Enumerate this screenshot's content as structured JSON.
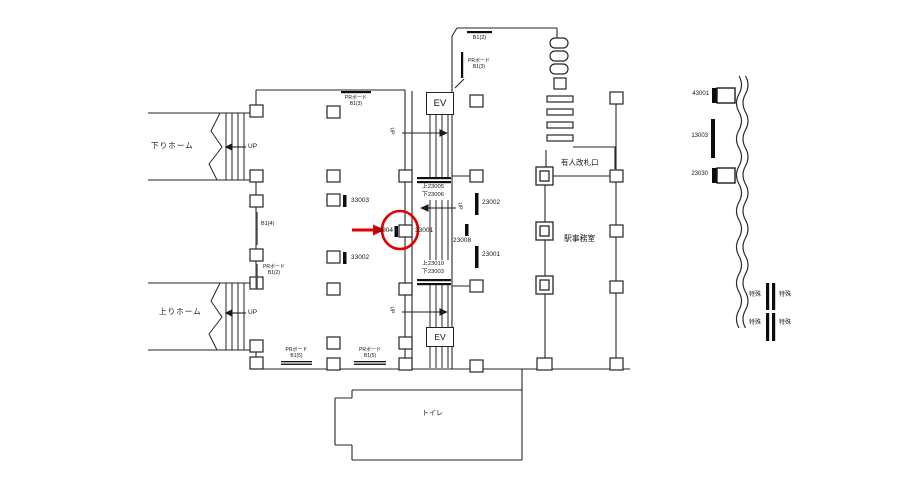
{
  "labels": {
    "platform_down": "下りホーム",
    "platform_up": "上りホーム",
    "up": "UP",
    "ev": "EV",
    "gate": "有人改札口",
    "office": "駅事務室",
    "toilet": "トイレ",
    "special": "特殊",
    "pr_board": "PRボード",
    "b1_2": "B1(2)",
    "b1_3": "B1(3)",
    "b1_4": "B1(4)",
    "b1_5": "B1(5)"
  },
  "boards": {
    "n33003": "33003",
    "n33002": "33002",
    "n33001": "33001",
    "n23004": "23004",
    "n23002": "23002",
    "n23008": "23008",
    "n23001": "23001",
    "n43001": "43001",
    "n13003": "13003",
    "n23030": "23030"
  },
  "escalator": {
    "top_up": "上23005",
    "top_down": "下23006",
    "bottom_up": "上23010",
    "bottom_down": "下23003"
  },
  "highlight": {
    "color": "#e10000",
    "target_board": "23004"
  }
}
